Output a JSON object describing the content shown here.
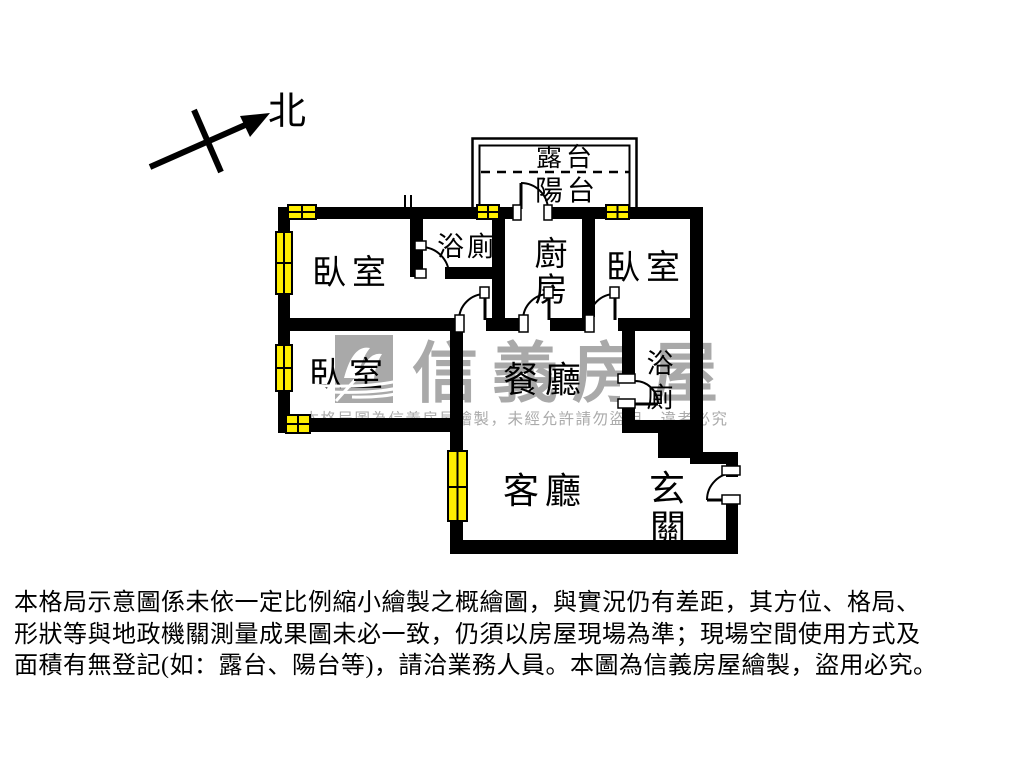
{
  "compass": {
    "north_label": "北"
  },
  "rooms": {
    "terrace": "露台",
    "balcony": "陽台",
    "bedroom_nw": "臥室",
    "bathroom_main": "浴廁",
    "kitchen_c1": "廚",
    "kitchen_c2": "房",
    "bedroom_ne": "臥室",
    "bedroom_w": "臥室",
    "dining": "餐廳",
    "bathroom2_c1": "浴",
    "bathroom2_c2": "廁",
    "living": "客廳",
    "foyer_c1": "玄",
    "foyer_c2": "關"
  },
  "watermark": {
    "brand": "信義房屋",
    "notice": "本格局圖為信義房屋繪製，未經允許請勿盜用，違者必究"
  },
  "disclaimer": {
    "line1": "本格局示意圖係未依一定比例縮小繪製之概繪圖，與實況仍有差距，其方位、格局、",
    "line2": "形狀等與地政機關測量成果圖未必一致，仍須以房屋現場為準；現場空間使用方式及",
    "line3": "面積有無登記(如：露台、陽台等)，請洽業務人員。本圖為信義房屋繪製，盜用必究。"
  },
  "colors": {
    "wall": "#000000",
    "window_fill": "#ffee00",
    "watermark_gray": "#a9a9a9"
  }
}
